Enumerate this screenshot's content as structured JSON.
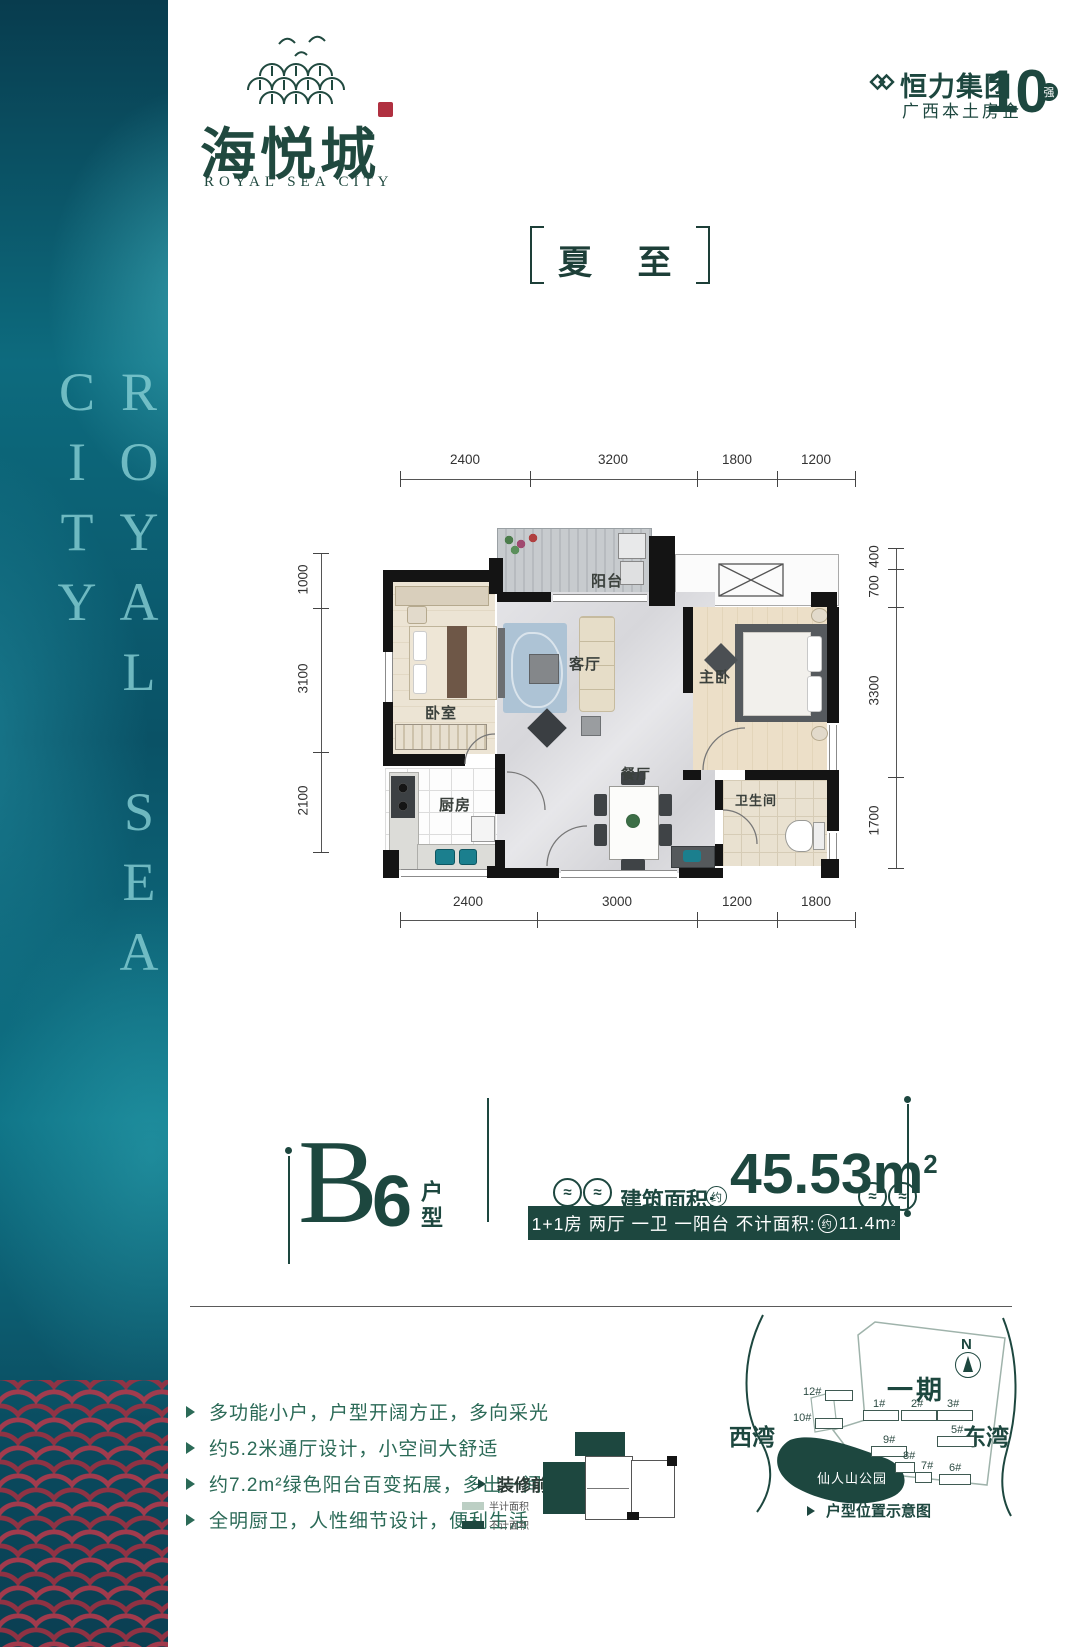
{
  "brand": {
    "name_cn": "海悦城",
    "name_en": "ROYAL SEA CITY",
    "side_vertical_text": "ROYAL SEA CITY"
  },
  "developer": {
    "name": "恒力集团",
    "rank_number": "10",
    "rank_badge": "强",
    "subtitle": "广西本土房企"
  },
  "season_title": {
    "text": "夏 至"
  },
  "floorplan": {
    "room_labels": {
      "balcony": "阳台",
      "bedroom": "卧室",
      "living": "客厅",
      "master": "主卧",
      "kitchen": "厨房",
      "dining": "餐厅",
      "bath": "卫生间"
    },
    "dims_top": [
      "2400",
      "3200",
      "1800",
      "1200"
    ],
    "dims_bottom": [
      "2400",
      "3000",
      "1200",
      "1800"
    ],
    "dims_left": [
      "1000",
      "3100",
      "2100"
    ],
    "dims_right": [
      "400",
      "700",
      "3300",
      "1700"
    ]
  },
  "unit_info": {
    "letter": "B",
    "number": "6",
    "type_suffix": "户型",
    "area_label": "建筑面积:",
    "area_approx": "约",
    "area_value": "45.53m",
    "area_sup": "2",
    "band_rooms": "1+1房 两厅 一卫 一阳台",
    "band_area_label": "不计面积:",
    "band_approx": "约",
    "band_value": "11.4m",
    "band_sup": "2"
  },
  "features": [
    {
      "text": "多功能小户，户型开阔方正，多向采光"
    },
    {
      "text": "约5.2米通厅设计，小空间大舒适"
    },
    {
      "text": "约7.2m²绿色阳台百变拓展，多出一间房"
    },
    {
      "text": "全明厨卫，人性细节设计，便利生活"
    }
  ],
  "mini_plan": {
    "label": "装修前",
    "legend_half": "半计面积",
    "legend_excluded": "不计面积"
  },
  "site_map": {
    "west_bay": "西湾",
    "east_bay": "东湾",
    "phase_label": "一期",
    "park_label": "仙人山公园",
    "compass": "N",
    "caption": "户型位置示意图",
    "buildings": [
      {
        "label": "12#"
      },
      {
        "label": "10#"
      },
      {
        "label": "1#"
      },
      {
        "label": "2#"
      },
      {
        "label": "3#"
      },
      {
        "label": "9#"
      },
      {
        "label": "8#"
      },
      {
        "label": "5#"
      },
      {
        "label": "7#"
      },
      {
        "label": "6#"
      }
    ]
  }
}
